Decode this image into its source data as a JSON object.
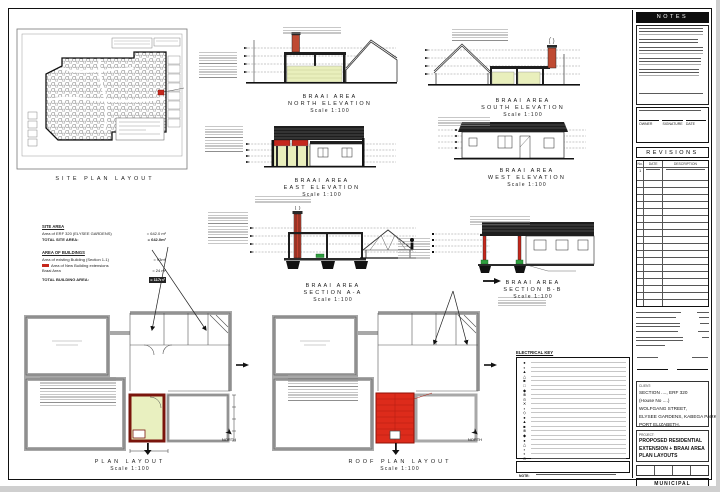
{
  "drawings": {
    "site_plan": {
      "caption": "SITE PLAN LAYOUT"
    },
    "north_elevation": {
      "title": "BRAAI AREA",
      "subtitle": "NORTH ELEVATION",
      "scale": "Scale 1:100"
    },
    "south_elevation": {
      "title": "BRAAI AREA",
      "subtitle": "SOUTH ELEVATION",
      "scale": "Scale 1:100"
    },
    "east_elevation": {
      "title": "BRAAI AREA",
      "subtitle": "EAST ELEVATION",
      "scale": "Scale 1:100"
    },
    "west_elevation": {
      "title": "BRAAI AREA",
      "subtitle": "WEST ELEVATION",
      "scale": "Scale 1:100"
    },
    "section_aa": {
      "title": "BRAAI AREA",
      "subtitle": "SECTION A-A",
      "scale": "Scale 1:100"
    },
    "section_bb": {
      "title": "BRAAI AREA",
      "subtitle": "SECTION B-B",
      "scale": "Scale 1:100"
    },
    "plan": {
      "title": "PLAN LAYOUT",
      "scale": "Scale 1:100",
      "north_label": "NORTH"
    },
    "roof_plan": {
      "title": "ROOF PLAN LAYOUT",
      "scale": "Scale 1:100",
      "north_label": "NORTH"
    }
  },
  "area_schedule": {
    "site_heading": "SITE AREA",
    "site_rows": [
      {
        "label": "Area of ERF 320 (ELYSEE GARDENS)",
        "value": "= 642.0 m²"
      },
      {
        "label": "TOTAL SITE AREA:",
        "value": "= 642.0m²"
      }
    ],
    "buildings_heading": "AREA OF BUILDINGS",
    "building_rows": [
      {
        "label": "Area of existing Building (Section 1-1)",
        "value": "= 93m²"
      },
      {
        "label": "Area of New Building extensions",
        "value": ""
      },
      {
        "label": "Braai Area",
        "value": "= 24 m²"
      },
      {
        "label": "TOTAL BUILDING AREA:",
        "value": "= 117m²"
      }
    ]
  },
  "electrical": {
    "title": "ELECTRICAL KEY",
    "note_label": "NOTE:",
    "symbols": [
      "●",
      "◐",
      "▲",
      "△",
      "■",
      "□",
      "◆",
      "⊗",
      "⊙",
      "✕",
      "▪",
      "◇",
      "●",
      "▲",
      "■",
      "⊗",
      "◆",
      "●",
      "△",
      "▪",
      "◐",
      "⊙"
    ]
  },
  "panel": {
    "notes_title": "NOTES",
    "revisions_title": "REVISIONS",
    "revisions_columns": [
      "No.",
      "DATE",
      "DESCRIPTION"
    ],
    "revision_first_no": "1",
    "revisions_empty_rows": 19,
    "signature_labels": [
      "OWNER",
      "SIGNATURE",
      "DATE"
    ],
    "client_label": "CLIENT:",
    "address_lines": [
      "SECTION ...., ERF 320",
      "(House No ....)",
      "WOLFGANG STREET,",
      "ELYSEE GARDENS, KABEGA PARK,",
      "PORT ELIZABETH."
    ],
    "project_label": "PROJECT:",
    "project_lines": [
      "PROPOSED RESIDENTIAL",
      "EXTENSION + BRAAI AREA",
      "PLAN LAYOUTS"
    ],
    "approval_label": "MUNICIPAL APPROVAL",
    "drawing_no_label": "DRAWING No.",
    "drawing_no": "PS-PL01",
    "sheet_label": "SHEET",
    "sheet_no": "1"
  },
  "colors": {
    "highlight_red": "#dd2b1b",
    "wall_red": "#c5271c",
    "brick": "#bf4a32",
    "new_wall_green": "#e9efbc",
    "marker_green": "#2f9e3f",
    "wall_gray": "#a8a8a8",
    "line": "#1a1a1a"
  }
}
